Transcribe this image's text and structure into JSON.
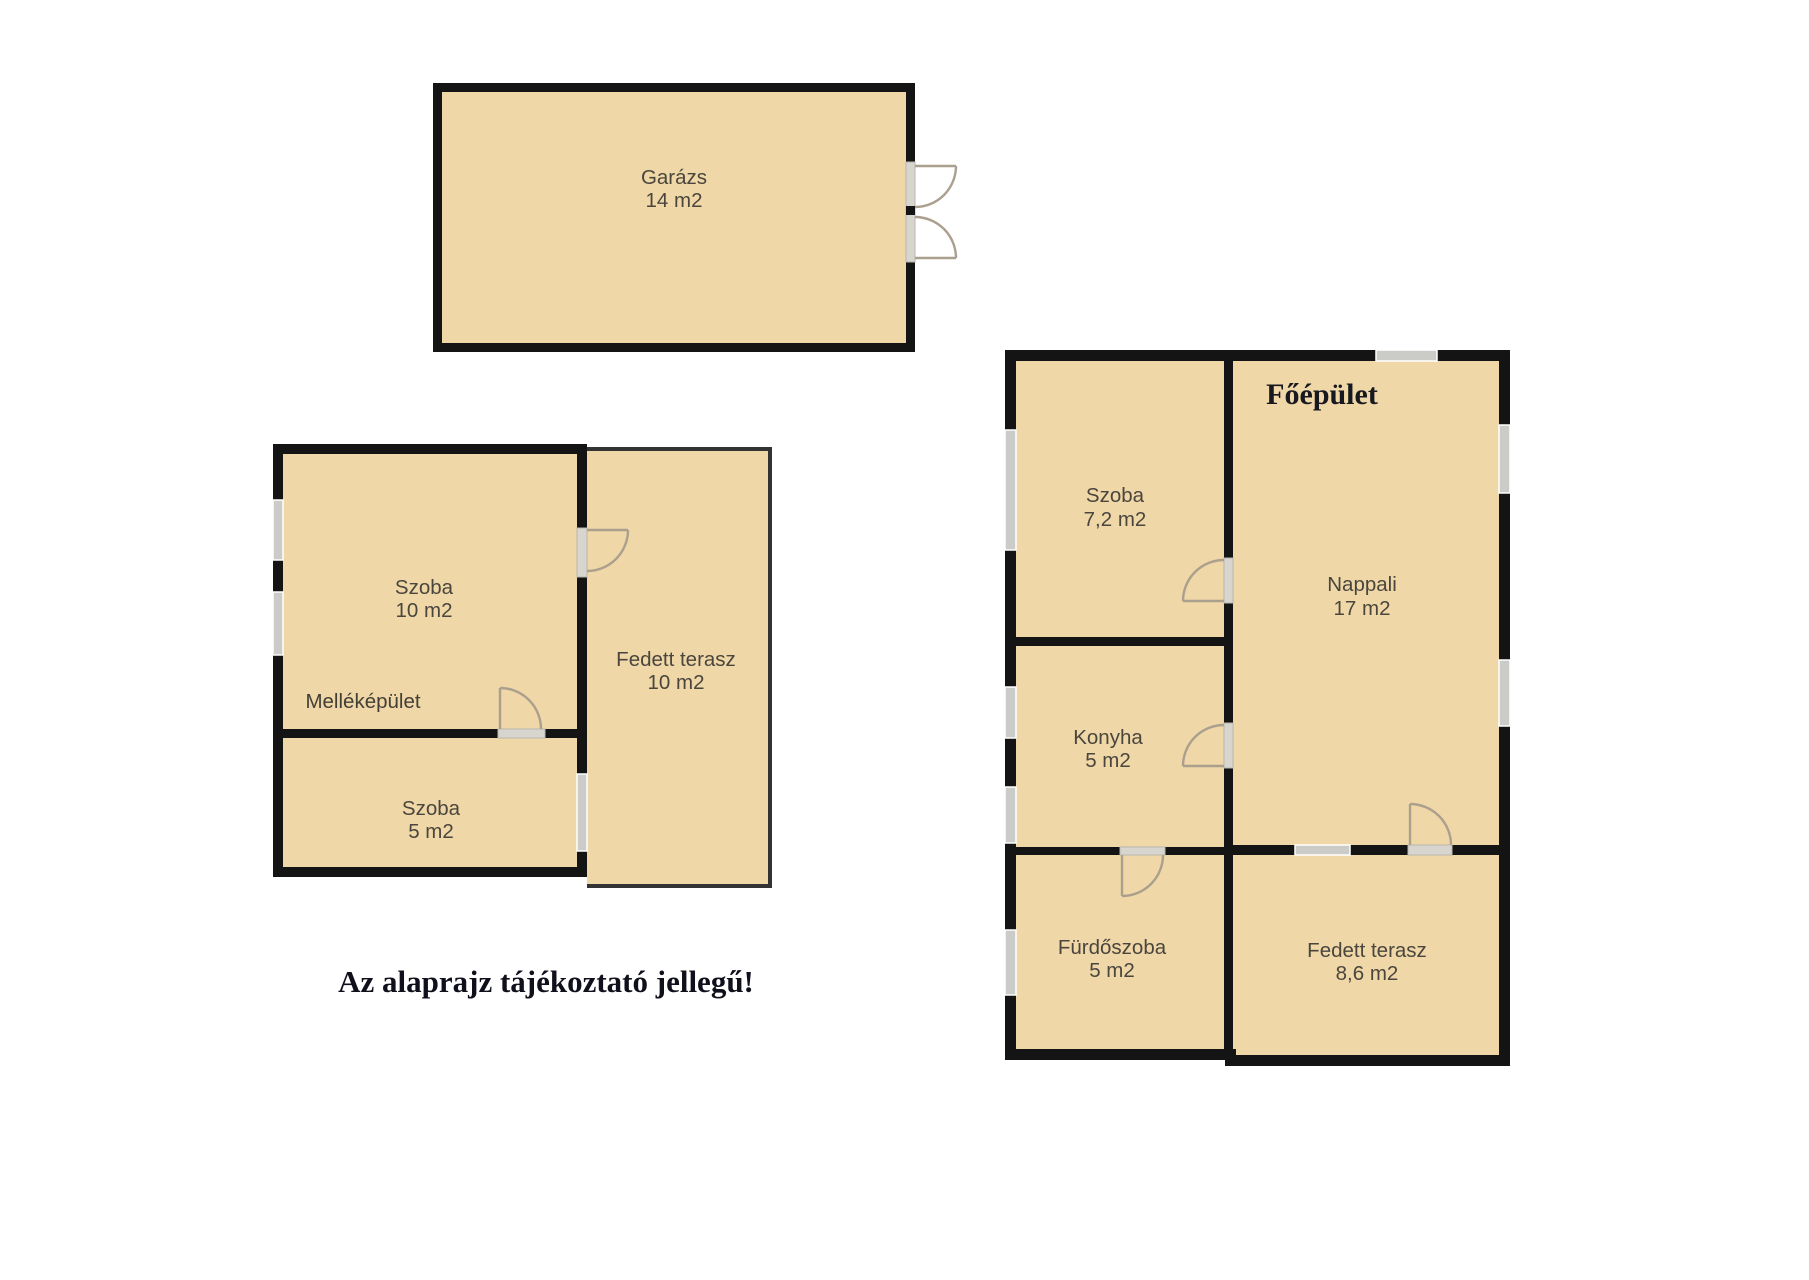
{
  "plan": {
    "disclaimer": "Az alaprajz tájékoztató jellegű!",
    "palette": {
      "background": "#ffffff",
      "room_fill": "#EFD7A7",
      "wall": "#141414",
      "window": "#cbcbc7",
      "door_arc": "#ab9f8d",
      "room_label_text": "#4a463e",
      "title_text": "#10101c"
    },
    "garage": {
      "name": "Garázs",
      "area": "14 m2"
    },
    "outbuilding": {
      "label": "Melléképület",
      "rooms": [
        {
          "name": "Szoba",
          "area": "10 m2"
        },
        {
          "name": "Szoba",
          "area": "5 m2"
        },
        {
          "name": "Fedett terasz",
          "area": "10 m2"
        }
      ]
    },
    "main_building": {
      "title": "Főépület",
      "rooms": [
        {
          "name": "Szoba",
          "area": "7,2 m2"
        },
        {
          "name": "Nappali",
          "area": "17 m2"
        },
        {
          "name": "Konyha",
          "area": "5 m2"
        },
        {
          "name": "Fürdőszoba",
          "area": "5 m2"
        },
        {
          "name": "Fedett terasz",
          "area": "8,6 m2"
        }
      ]
    }
  }
}
